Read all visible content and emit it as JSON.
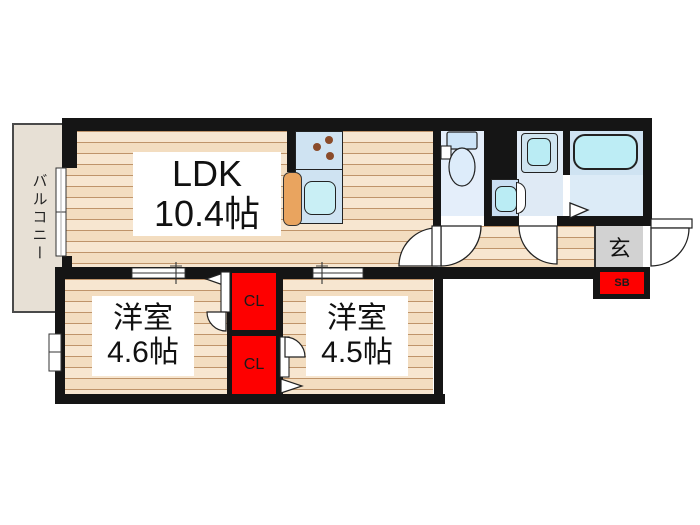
{
  "plan": {
    "ldk": {
      "name": "LDK",
      "size": "10.4帖"
    },
    "bedroom_left": {
      "name": "洋室",
      "size": "4.6帖"
    },
    "bedroom_right": {
      "name": "洋室",
      "size": "4.5帖"
    },
    "balcony_label": "バルコニー",
    "entrance_label": "玄",
    "closet_top_label": "CL",
    "closet_bottom_label": "CL",
    "shoebox_label": "SB"
  },
  "colors": {
    "wall": "#151515",
    "wood_base": "#f7e6d0",
    "wood_line": "#bf946a",
    "wood_alt": "#f3ddc0",
    "closet_red": "#fe0000",
    "genkan_gray": "#d2d2d2",
    "fixture_blue": "#cfe3f2",
    "water_cyan": "#bdedf5",
    "washroom_blue": "#dfeaf5",
    "toilet_floor": "#e4eefa",
    "bath_floor": "#dcebf7",
    "cabinet_orange": "#e9a45f",
    "balcony_fill": "#e7e0d5",
    "burner_brown": "#8a4b2a"
  }
}
